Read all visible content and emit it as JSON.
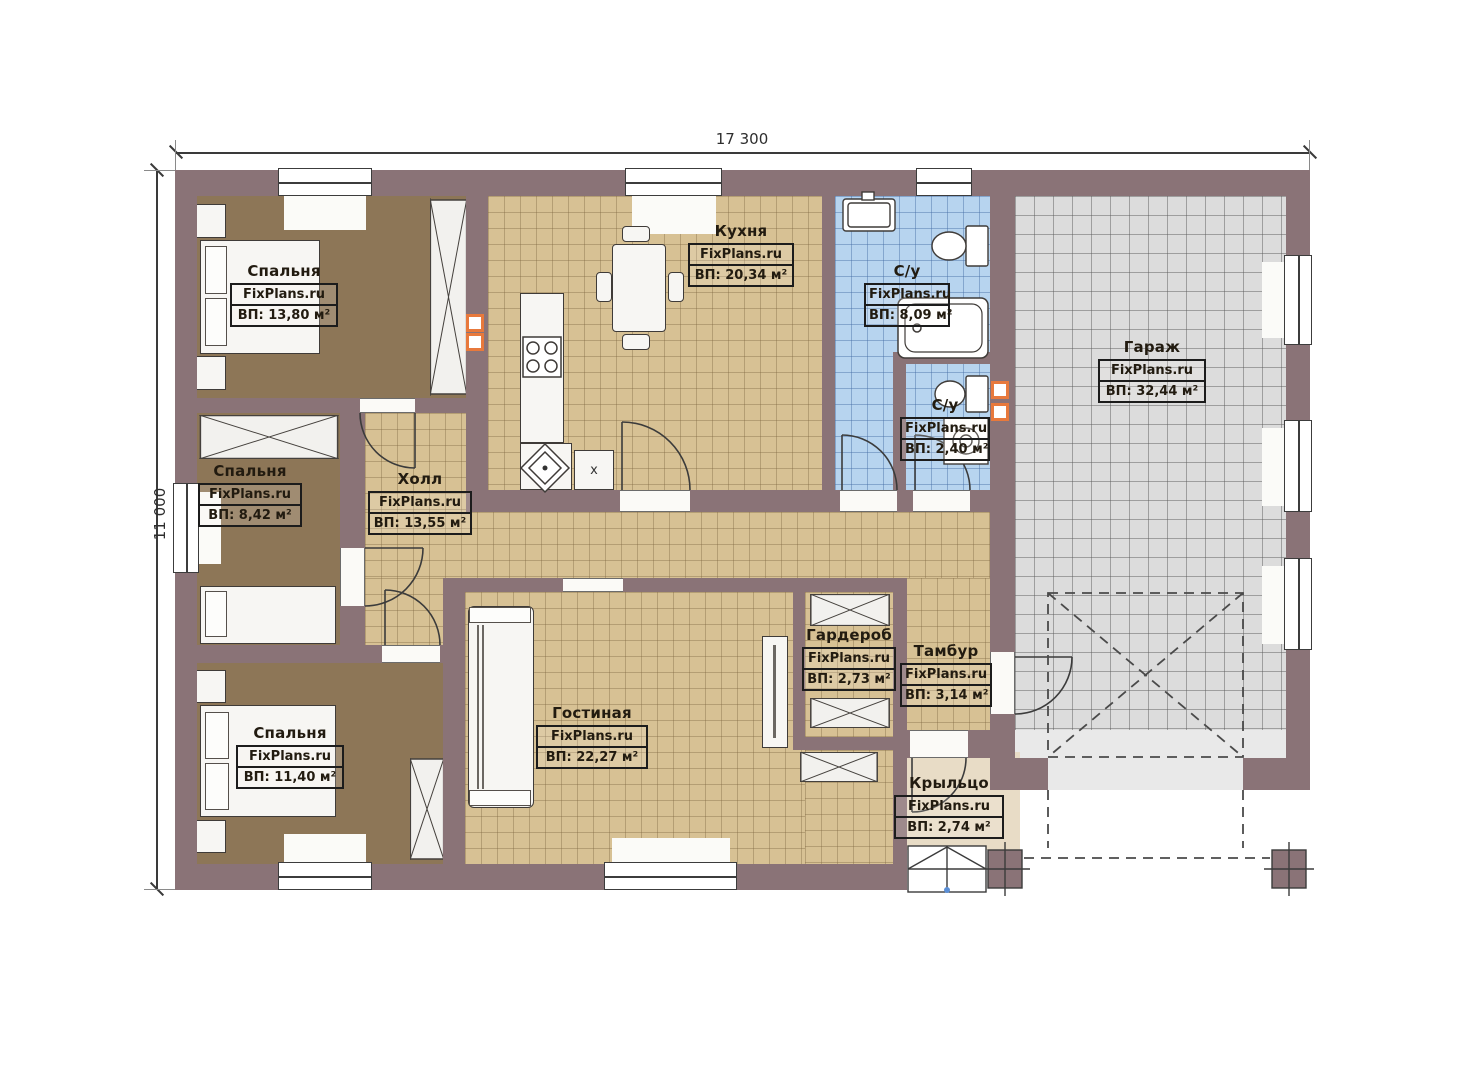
{
  "plan": {
    "dimensions": {
      "width_label": "17 300",
      "height_label": "11 000"
    },
    "rooms": [
      {
        "id": "bedroom1",
        "name": "Спальня",
        "watermark": "FixPlans.ru",
        "area": "ВП: 13,80 м²"
      },
      {
        "id": "bedroom2",
        "name": "Спальня",
        "watermark": "FixPlans.ru",
        "area": "ВП: 8,42 м²"
      },
      {
        "id": "bedroom3",
        "name": "Спальня",
        "watermark": "FixPlans.ru",
        "area": "ВП: 11,40 м²"
      },
      {
        "id": "kitchen",
        "name": "Кухня",
        "watermark": "FixPlans.ru",
        "area": "ВП: 20,34 м²"
      },
      {
        "id": "bathroom1",
        "name": "С/у",
        "watermark": "FixPlans.ru",
        "area": "ВП: 8,09 м²"
      },
      {
        "id": "bathroom2",
        "name": "С/у",
        "watermark": "FixPlans.ru",
        "area": "ВП: 2,40 м²"
      },
      {
        "id": "garage",
        "name": "Гараж",
        "watermark": "FixPlans.ru",
        "area": "ВП: 32,44 м²"
      },
      {
        "id": "hall",
        "name": "Холл",
        "watermark": "FixPlans.ru",
        "area": "ВП: 13,55 м²"
      },
      {
        "id": "living",
        "name": "Гостиная",
        "watermark": "FixPlans.ru",
        "area": "ВП: 22,27 м²"
      },
      {
        "id": "wardrobe",
        "name": "Гардероб",
        "watermark": "FixPlans.ru",
        "area": "ВП: 2,73 м²"
      },
      {
        "id": "vestibule",
        "name": "Тамбур",
        "watermark": "FixPlans.ru",
        "area": "ВП: 3,14 м²"
      },
      {
        "id": "porch",
        "name": "Крыльцо",
        "watermark": "FixPlans.ru",
        "area": "ВП: 2,74 м²"
      }
    ],
    "markers": {
      "kitchen_table_x": "x"
    },
    "colors": {
      "wall": "#8a7377",
      "bedroom_floor": "#8d7657",
      "tile_tan": "#d7c194",
      "tile_blue": "#b7d4ef",
      "tile_gray": "#dcdcdc",
      "porch": "#e8dcc6",
      "vent_accent": "#e8793c"
    }
  }
}
